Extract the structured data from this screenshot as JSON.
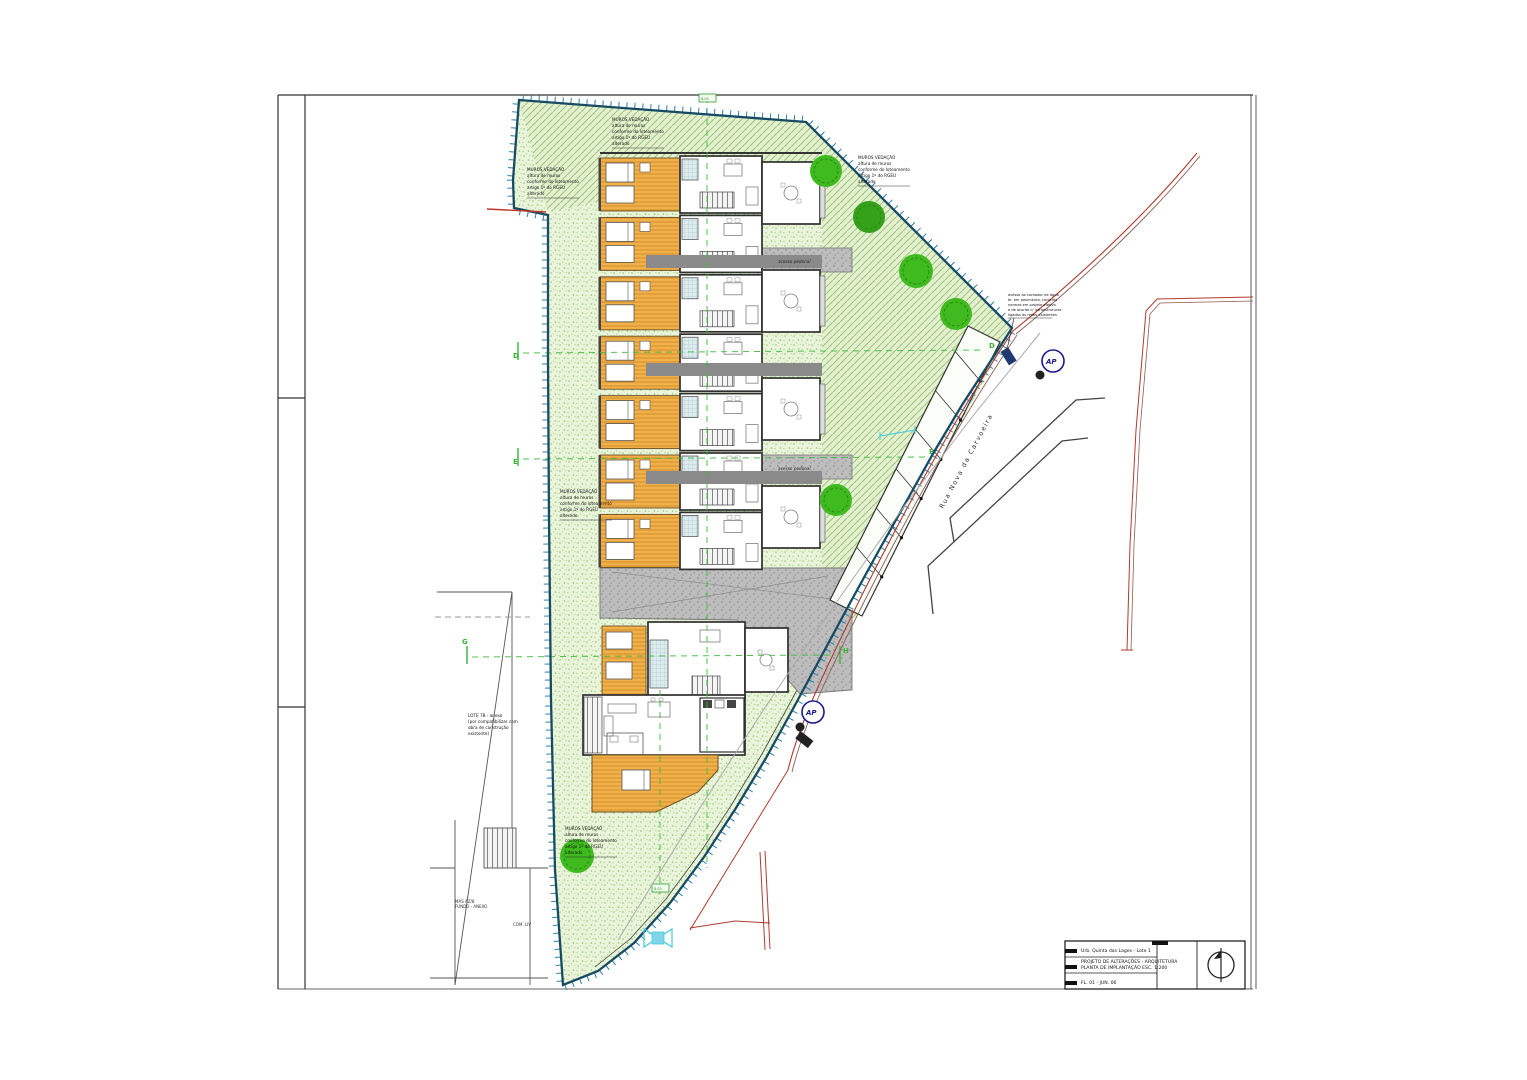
{
  "colors": {
    "boundary_navy": "#174a63",
    "tick_blue": "#2e7fa8",
    "lawn_bg": "#e9f4da",
    "lawn_dot": "#92c471",
    "hatch_bg": "#e4f0d0",
    "hatch_line": "#9cc87e",
    "deck_orange": "#f2b049",
    "paved_gray": "#bdbdbd",
    "grid_green": "#3dbb3d",
    "road_red": "#b03a2e",
    "ap_navy": "#1a1a8f",
    "tree_green": "#3fbb1f",
    "cyan": "#45cbe0"
  },
  "grid": {
    "d": "D",
    "e": "E",
    "g": "G",
    "h": "H",
    "d_right": "D",
    "e_right": "E",
    "top_tag": "B.05",
    "bottom_tag": "B.05"
  },
  "street": {
    "name": "Rua Nova da Carvoeira"
  },
  "paths": {
    "label_upper": "acesso pedonal",
    "label_lower": "acesso pedonal"
  },
  "symbols": {
    "ap_upper": "AP",
    "ap_lower": "AP"
  },
  "notes": {
    "wall_top_center": {
      "lines": [
        "MUROS VEDAÇÃO",
        "altura de muros",
        "conforme do loteamento",
        "artigo 1º do RGEU",
        "alterado"
      ]
    },
    "wall_top_left": {
      "lines": [
        "MUROS VEDAÇÃO",
        "altura de muros",
        "conforme do loteamento",
        "artigo 1º do RGEU",
        "alterado"
      ]
    },
    "wall_top_right": {
      "lines": [
        "MUROS VEDAÇÃO",
        "altura de muros",
        "conforme do loteamento",
        "artigo 1º do RGEU",
        "alterado"
      ]
    },
    "wall_mid_left": {
      "lines": [
        "MUROS VEDAÇÃO",
        "altura de muros",
        "conforme do loteamento",
        "artigo 1º do RGEU",
        "alterado"
      ]
    },
    "wall_bottom": {
      "lines": [
        "MUROS VEDAÇÃO",
        "altura de muros",
        "conforme do loteamento",
        "artigo 1º do RGEU",
        "alterado"
      ]
    },
    "annex_left": {
      "lines": [
        "LOTE 7B - anexo",
        "(por compatibilizar com",
        "obra de construção",
        "existente)"
      ]
    },
    "entrance": {
      "lines": [
        "acesso ao contador de água",
        "br. em pavimento, consulta",
        "normas em projeto efetivo",
        "e de acordo c/ infraestruturas",
        "ligadas às redes existentes"
      ]
    }
  },
  "neighbor": {
    "plot_label_a1": "MAS AZ/8",
    "plot_label_a2": "FUNDO - ANEXO",
    "plot_label_b": "COM. LIV"
  },
  "title_block": {
    "row1": "Urb. Quinta das Lages - Lote 1",
    "row2a": "PROJETO DE ALTERAÇÕES - ARQUITETURA",
    "row2b": "PLANTA DE IMPLANTAÇÃO  ESC. 1:200",
    "row3": "FL. 01 - JUN. 06"
  }
}
